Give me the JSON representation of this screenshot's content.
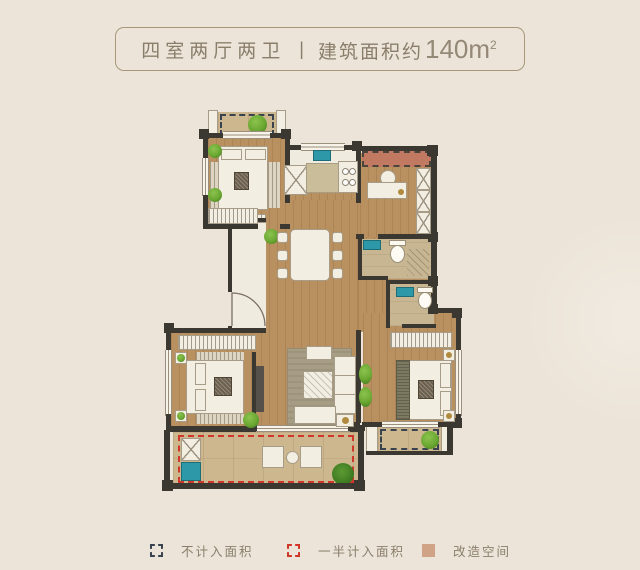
{
  "title": {
    "rooms": "四室两厅两卫",
    "separator": "|",
    "area_label": "建筑面积约",
    "area_number": "140m",
    "area_sup": "2"
  },
  "legend": {
    "items": [
      {
        "label": "不计入面积",
        "swatch": "navy-dashed-square"
      },
      {
        "label": "一半计入面积",
        "swatch": "red-dashed-square"
      },
      {
        "label": "改造空间",
        "swatch": "salmon-solid-square"
      }
    ]
  },
  "colors": {
    "bg": "#ece4d8",
    "ink": "#8a7e6b",
    "boxline": "#a79878",
    "wall": "#3b3731",
    "wood": "#b9905f",
    "balcony": "#cdb78f",
    "tilefloor": "#c7b691",
    "counter": "#c9bd9a",
    "cream": "#f3eee2",
    "creamline": "#a69c88",
    "teal": "#2d98a8",
    "green": "#6aa832",
    "greendark": "#41761d",
    "salmon": "#c17a61",
    "red": "#d0372a",
    "navy": "#39434f",
    "rug": "#a79d85",
    "darkfur": "#55504a",
    "gold": "#b08a3e"
  }
}
